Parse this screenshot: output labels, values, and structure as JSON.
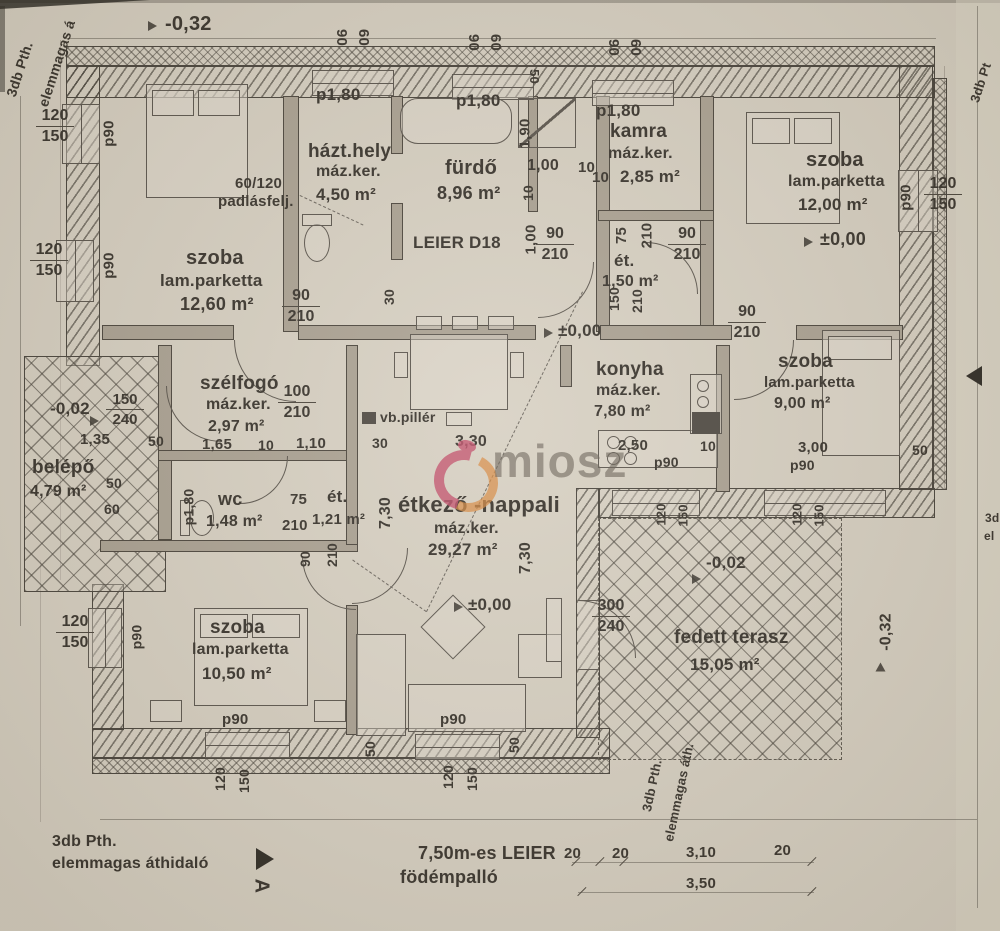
{
  "colors": {
    "paper": "#d7d0c2",
    "ink": "#37322b",
    "watermark_pink": "#c24f6a",
    "watermark_orange": "#d7893f",
    "watermark_text": "#68604f"
  },
  "levels": {
    "zero": "±0,00",
    "minus002": "-0,02",
    "minus032": "-0,32"
  },
  "dims": {
    "v10": "10",
    "v20": "20",
    "v30": "30",
    "v50": "50",
    "v60": "60",
    "v75": "75",
    "v90": "90",
    "v100": "100",
    "v120": "120",
    "v150": "150",
    "v210": "210",
    "v240": "240",
    "v300": "300",
    "p90": "p90",
    "p180": "p1,80",
    "m100": "1,00",
    "m110": "1,10",
    "m135": "1,35",
    "m165": "1,65",
    "m190": "1,90",
    "m250": "2,50",
    "m300": "3,00",
    "m310": "3,10",
    "m330": "3,30",
    "m350": "3,50",
    "m730": "7,30"
  },
  "rooms": {
    "szoba_tl": {
      "name": "szoba",
      "floor": "lam.parketta",
      "area": "12,60 m²"
    },
    "hazt": {
      "name": "házt.hely",
      "floor": "máz.ker.",
      "area": "4,50 m²"
    },
    "furdo": {
      "name": "fürdő",
      "area": "8,96 m²"
    },
    "kamra": {
      "name": "kamra",
      "floor": "máz.ker.",
      "area": "2,85 m²"
    },
    "szoba_tr": {
      "name": "szoba",
      "floor": "lam.parketta",
      "area": "12,00 m²"
    },
    "et_kamra": {
      "name": "ét.",
      "area": "1,50 m²"
    },
    "szelfogo": {
      "name": "szélfogó",
      "floor": "máz.ker.",
      "area": "2,97 m²"
    },
    "belepo": {
      "name": "belépő",
      "area": "4,79 m²"
    },
    "wc": {
      "name": "wc",
      "area": "1,48 m²"
    },
    "et_wc": {
      "name": "ét.",
      "area": "1,21 m²"
    },
    "etkezo": {
      "name": "étkező -nappali",
      "floor": "máz.ker.",
      "area": "29,27 m²"
    },
    "konyha": {
      "name": "konyha",
      "floor": "máz.ker.",
      "area": "7,80 m²"
    },
    "szoba_mr": {
      "name": "szoba",
      "floor": "lam.parketta",
      "area": "9,00 m²"
    },
    "szoba_bl": {
      "name": "szoba",
      "floor": "lam.parketta",
      "area": "10,50 m²"
    },
    "terasz": {
      "name": "fedett terasz",
      "area": "15,05 m²"
    }
  },
  "annotations": {
    "attic1": "60/120",
    "attic2": "padlásfelj.",
    "leier": "LEIER D18",
    "vb": "vb.pillér",
    "slab1": "7,50m-es LEIER",
    "slab2": "födémpalló",
    "lintel1": "3db Pth.",
    "lintel2": "elemmagas áthidaló",
    "lintel2_short": "elemmagas áth.",
    "lintel_left_cut": "elemmagas á",
    "lintel_tr_cut": "3db Pt",
    "cut_3d": "3d",
    "cut_el": "el",
    "section_a": "A"
  },
  "watermark": {
    "text": "miosz"
  }
}
